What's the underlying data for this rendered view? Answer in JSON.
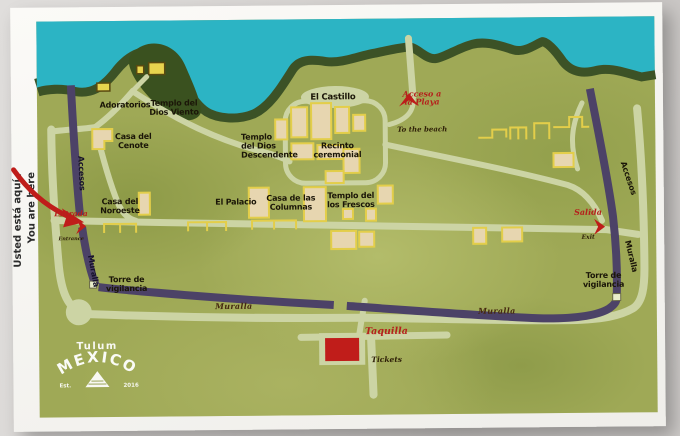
{
  "sign": {
    "you_are_here": {
      "line1": "Usted está aquí /",
      "line2": "You are here"
    }
  },
  "map": {
    "labels": {
      "adoratorios": "Adoratorios",
      "templo_dios_viento": "Templo del\nDios Viento",
      "casa_del_cenote": "Casa del\nCenote",
      "el_castillo": "El Castillo",
      "templo_dios_descendente": "Templo\ndel Dios\nDescendente",
      "recinto_ceremonial": "Recinto\nceremonial",
      "casa_del_noroeste": "Casa del\nNoroeste",
      "el_palacio": "El Palacio",
      "casa_de_las_columnas": "Casa de las\nColumnas",
      "templo_de_los_frescos": "Templo del\nlos Frescos",
      "torre_vigilancia_left": "Torre de\nvigilancia",
      "torre_vigilancia_right": "Torre de\nvigilancia",
      "accesos_left": "Accesos",
      "accesos_right": "Accesos",
      "muralla_left": "Muralla",
      "muralla_right": "Muralla",
      "muralla_bottom_left": "Muralla",
      "muralla_bottom_right": "Muralla"
    },
    "poi": {
      "entrada": {
        "label": "Entrada",
        "sub": "Entrance"
      },
      "salida": {
        "label": "Salida",
        "sub": "Exit"
      },
      "playa": {
        "label": "Acceso a\nla Playa",
        "sub": "To the beach"
      },
      "taquilla": {
        "label": "Taquilla",
        "sub": "Tickets"
      }
    },
    "colors": {
      "sea": "#2cb4c4",
      "coast": "#3c5226",
      "land": "#9fa956",
      "wall": "#4c4267",
      "path": "#ccd4a4",
      "building_fill": "#e7d6b0",
      "building_outline": "#e3ce4a",
      "accent_red": "#bf1d1a"
    }
  },
  "logo": {
    "top": "Tulum",
    "name": "MEXICO",
    "left": "Est.",
    "right": "2016"
  }
}
